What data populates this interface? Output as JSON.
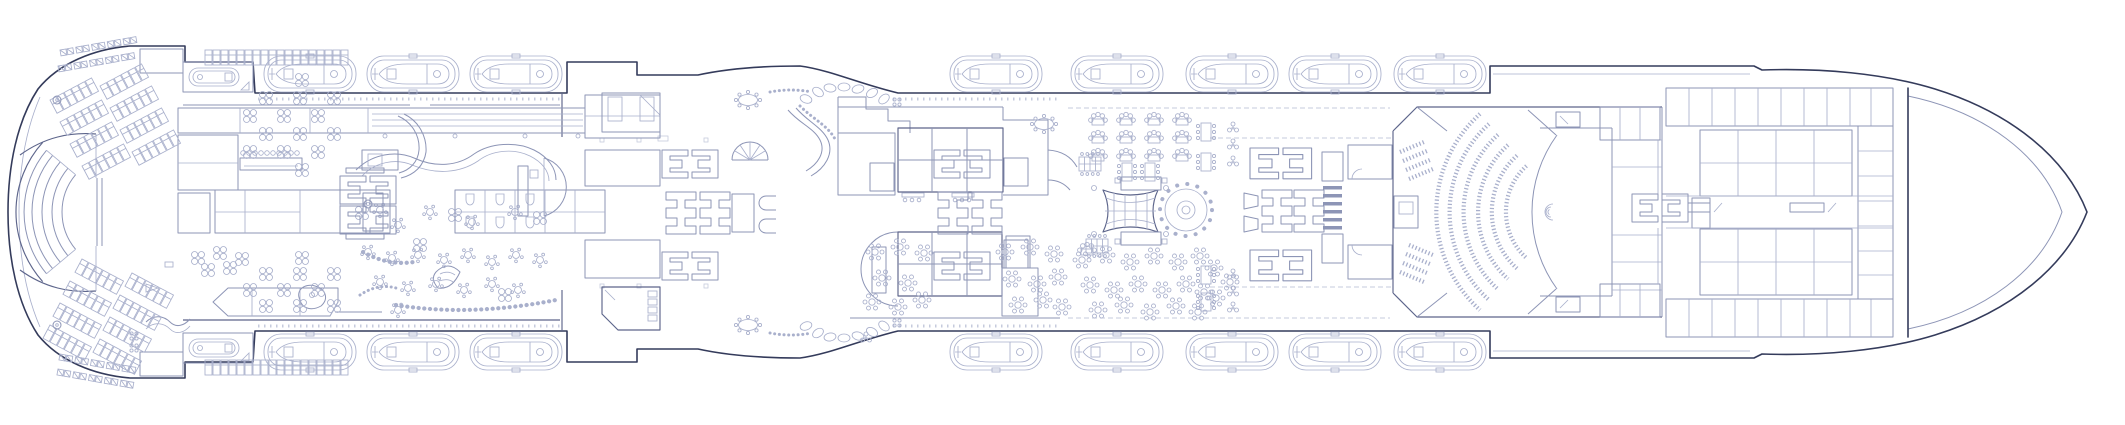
{
  "meta": {
    "title": "Cruise ship deck plan",
    "description": "Top-view deck plan line drawing of a cruise ship, stern at left, bow pointing right, no text labels visible",
    "orientation": "bow-right"
  },
  "colors": {
    "hull": "#343b5b",
    "dark": "#5d658b",
    "wall": "#8d95b6",
    "light": "#a9b0cc",
    "xlight": "#c6cbdd",
    "background": "#ffffff"
  },
  "inventory": {
    "lifeboats": 16,
    "stern_tenders": 2,
    "theatre_seat_rows": 6,
    "elevator_banks": 4,
    "staircases": 10
  },
  "zones": [
    {
      "id": "stern-sun-deck",
      "name": "Stern open deck with sun loungers and four-seat tables"
    },
    {
      "id": "stern-amphitheatre",
      "name": "Aft fan-shaped amphitheatre with stage"
    },
    {
      "id": "aft-elevator-bank",
      "name": "Aft elevator lobby"
    },
    {
      "id": "gallery-bar",
      "name": "Port-side gallery block and bar with stools"
    },
    {
      "id": "lounge",
      "name": "Main lounge with wavy walls, piano bar and scattered tables"
    },
    {
      "id": "casino-restrooms",
      "name": "Casino block and restroom stalls"
    },
    {
      "id": "midship-elevator-banks",
      "name": "Two midship elevator banks with stairs"
    },
    {
      "id": "dining-upper",
      "name": "Upper dining room block with glazed grid"
    },
    {
      "id": "dining-lower",
      "name": "Lower dining room block with rounded end"
    },
    {
      "id": "atrium",
      "name": "Central atrium with mesh sculpture and twin staircases"
    },
    {
      "id": "dance-floor",
      "name": "Circular dance floor ringed by chairs"
    },
    {
      "id": "banquet-area",
      "name": "Banquet seating field with star-shaped table clusters"
    },
    {
      "id": "pre-theatre-lobby",
      "name": "Theatre lobby with service blocks and escalators"
    },
    {
      "id": "theatre",
      "name": "Main theatre with curved seat rows and stage"
    },
    {
      "id": "backstage",
      "name": "Backstage rooms and forward elevator lobby"
    },
    {
      "id": "forward-cabins",
      "name": "Forward cabin grid with central corridors"
    },
    {
      "id": "forecastle",
      "name": "Forecastle deck and pointed bow"
    },
    {
      "id": "lifeboat-rows",
      "name": "Lifeboats in davits along both sides"
    }
  ],
  "stamps": {
    "lifeboat": {
      "symbol": "sy-boat",
      "items": [
        [
          264,
          56
        ],
        [
          367,
          56
        ],
        [
          470,
          56
        ],
        [
          950,
          56
        ],
        [
          1071,
          56
        ],
        [
          1186,
          56
        ],
        [
          1289,
          56
        ],
        [
          1394,
          56
        ],
        [
          264,
          334
        ],
        [
          367,
          334
        ],
        [
          470,
          334
        ],
        [
          950,
          334
        ],
        [
          1071,
          334
        ],
        [
          1186,
          334
        ],
        [
          1289,
          334
        ],
        [
          1394,
          334
        ]
      ]
    },
    "tender": {
      "symbol": "sy-rescue",
      "items": [
        [
          183,
          62
        ],
        [
          183,
          333
        ]
      ]
    },
    "lounger-row": {
      "symbol": "sy-chairrow",
      "items": [
        [
          50,
          100,
          -28
        ],
        [
          60,
          122,
          -28
        ],
        [
          70,
          144,
          -28
        ],
        [
          82,
          166,
          -28
        ],
        [
          100,
          86,
          -28
        ],
        [
          110,
          108,
          -28
        ],
        [
          120,
          130,
          -28
        ],
        [
          132,
          152,
          -28
        ],
        [
          50,
          325,
          28
        ],
        [
          60,
          303,
          28
        ],
        [
          70,
          281,
          28
        ],
        [
          82,
          259,
          28
        ],
        [
          100,
          339,
          28
        ],
        [
          110,
          317,
          28
        ],
        [
          120,
          295,
          28
        ],
        [
          132,
          273,
          28
        ],
        [
          205,
          50
        ],
        [
          253,
          50
        ],
        [
          301,
          50
        ],
        [
          205,
          360
        ],
        [
          253,
          360
        ],
        [
          301,
          360
        ]
      ]
    },
    "lounger-pairs": {
      "symbol": "sy-pairrow",
      "items": [
        [
          60,
          50,
          -10
        ],
        [
          58,
          66,
          -10
        ],
        [
          60,
          354,
          10
        ],
        [
          58,
          369,
          10
        ]
      ]
    },
    "table-4top": {
      "symbol": "sy-table4",
      "items": [
        [
          302,
          80
        ],
        [
          266,
          98
        ],
        [
          300,
          98
        ],
        [
          334,
          98
        ],
        [
          250,
          116
        ],
        [
          284,
          116
        ],
        [
          318,
          116
        ],
        [
          266,
          134
        ],
        [
          300,
          134
        ],
        [
          334,
          134
        ],
        [
          250,
          152
        ],
        [
          284,
          152
        ],
        [
          318,
          152
        ],
        [
          302,
          170
        ],
        [
          302,
          258
        ],
        [
          266,
          274
        ],
        [
          300,
          274
        ],
        [
          334,
          274
        ],
        [
          250,
          290
        ],
        [
          284,
          290
        ],
        [
          318,
          290
        ],
        [
          266,
          306
        ],
        [
          300,
          306
        ],
        [
          334,
          306
        ],
        [
          198,
          258
        ],
        [
          220,
          253
        ],
        [
          242,
          259
        ],
        [
          208,
          270
        ],
        [
          230,
          268
        ],
        [
          362,
          213
        ],
        [
          455,
          215
        ],
        [
          540,
          218
        ],
        [
          420,
          245
        ],
        [
          505,
          295
        ]
      ]
    },
    "round-table": {
      "symbol": "sy-round",
      "items": [
        [
          380,
          210
        ],
        [
          398,
          225
        ],
        [
          430,
          212
        ],
        [
          472,
          222
        ],
        [
          515,
          212
        ],
        [
          368,
          252
        ],
        [
          392,
          258
        ],
        [
          418,
          255
        ],
        [
          444,
          260
        ],
        [
          468,
          255
        ],
        [
          492,
          262
        ],
        [
          516,
          255
        ],
        [
          540,
          260
        ],
        [
          380,
          282
        ],
        [
          408,
          288
        ],
        [
          436,
          284
        ],
        [
          464,
          290
        ],
        [
          492,
          284
        ],
        [
          518,
          290
        ],
        [
          398,
          310
        ]
      ]
    },
    "star-table": {
      "symbol": "sy-star",
      "items": [
        [
          875,
          252
        ],
        [
          900,
          247
        ],
        [
          924,
          253
        ],
        [
          882,
          278
        ],
        [
          908,
          283
        ],
        [
          872,
          302
        ],
        [
          898,
          307
        ],
        [
          922,
          300
        ],
        [
          1005,
          252
        ],
        [
          1030,
          247
        ],
        [
          1054,
          254
        ],
        [
          1012,
          279
        ],
        [
          1037,
          284
        ],
        [
          1058,
          277
        ],
        [
          1018,
          305
        ],
        [
          1043,
          300
        ],
        [
          1062,
          307
        ],
        [
          1082,
          260
        ],
        [
          1106,
          255
        ],
        [
          1130,
          262
        ],
        [
          1154,
          256
        ],
        [
          1178,
          262
        ],
        [
          1200,
          256
        ],
        [
          1090,
          285
        ],
        [
          1114,
          290
        ],
        [
          1138,
          284
        ],
        [
          1162,
          290
        ],
        [
          1186,
          284
        ],
        [
          1204,
          292
        ],
        [
          1098,
          310
        ],
        [
          1124,
          305
        ],
        [
          1150,
          312
        ],
        [
          1176,
          306
        ],
        [
          1198,
          312
        ],
        [
          1214,
          268
        ],
        [
          1230,
          282
        ],
        [
          1216,
          298
        ]
      ]
    },
    "banquet-cluster": {
      "symbol": "sy-scallop",
      "items": [
        [
          1098,
          122
        ],
        [
          1126,
          122
        ],
        [
          1154,
          122
        ],
        [
          1182,
          122
        ],
        [
          1098,
          140
        ],
        [
          1126,
          140
        ],
        [
          1154,
          140
        ],
        [
          1182,
          140
        ],
        [
          1098,
          158
        ],
        [
          1126,
          158
        ],
        [
          1154,
          158
        ],
        [
          1182,
          158
        ],
        [
          1087,
          252
        ]
      ]
    },
    "long-table": {
      "symbol": "sy-banq",
      "items": [
        [
          1206,
          132,
          90
        ],
        [
          1206,
          162,
          90
        ],
        [
          1206,
          275,
          90
        ],
        [
          1206,
          302,
          90
        ],
        [
          1127,
          172,
          90
        ],
        [
          1150,
          172,
          90
        ]
      ]
    },
    "conference-table": {
      "symbol": "sy-conf",
      "items": [
        [
          1090,
          164
        ],
        [
          1097,
          246
        ]
      ]
    },
    "oval-table": {
      "symbol": "sy-oval8",
      "items": [
        [
          1044,
          124
        ],
        [
          748,
          100
        ],
        [
          748,
          325
        ]
      ]
    },
    "plant": {
      "symbol": "sy-plant",
      "items": [
        [
          1233,
          128
        ],
        [
          1233,
          145
        ],
        [
          1233,
          162
        ],
        [
          1233,
          275
        ],
        [
          1233,
          292
        ],
        [
          1233,
          308
        ],
        [
          866,
          338
        ]
      ]
    },
    "dot-cluster": {
      "symbol": "sy-dots4",
      "items": [
        [
          897,
          102
        ],
        [
          897,
          323
        ],
        [
          134,
          336
        ],
        [
          134,
          348
        ]
      ]
    },
    "planter-rock": {
      "symbol": "sy-pebble",
      "items": [
        [
          806,
          99,
          20
        ],
        [
          818,
          92,
          35
        ],
        [
          830,
          88,
          10
        ],
        [
          844,
          87,
          0
        ],
        [
          858,
          89,
          -15
        ],
        [
          872,
          93,
          -30
        ],
        [
          884,
          99,
          -40
        ],
        [
          806,
          326,
          -20
        ],
        [
          818,
          333,
          -35
        ],
        [
          830,
          337,
          -10
        ],
        [
          844,
          338,
          0
        ],
        [
          858,
          336,
          15
        ],
        [
          872,
          332,
          30
        ],
        [
          884,
          326,
          40
        ]
      ]
    },
    "davit-circle": {
      "symbol": "sy-circleD",
      "items": [
        [
          57,
          100
        ],
        [
          57,
          325
        ]
      ]
    },
    "wc-stall": {
      "symbol": "sy-wc",
      "items": [
        [
          470,
          200
        ],
        [
          500,
          200
        ],
        [
          530,
          200
        ],
        [
          470,
          223
        ],
        [
          500,
          223
        ],
        [
          530,
          223
        ]
      ]
    },
    "elevator-pair": {
      "symbol": "sy-epair",
      "items": [
        [
          340,
          176
        ],
        [
          340,
          206
        ],
        [
          662,
          150
        ],
        [
          662,
          252
        ],
        [
          934,
          150
        ],
        [
          934,
          252
        ],
        [
          1632,
          194
        ],
        [
          1250,
          148,
          0,
          1.1
        ],
        [
          1250,
          250,
          0,
          1.1
        ]
      ]
    },
    "elevator-h": {
      "symbol": "sy-H",
      "items": [
        [
          666,
          192
        ],
        [
          700,
          192
        ],
        [
          938,
          192
        ],
        [
          972,
          192
        ],
        [
          1262,
          190
        ],
        [
          1294,
          190
        ]
      ]
    }
  }
}
